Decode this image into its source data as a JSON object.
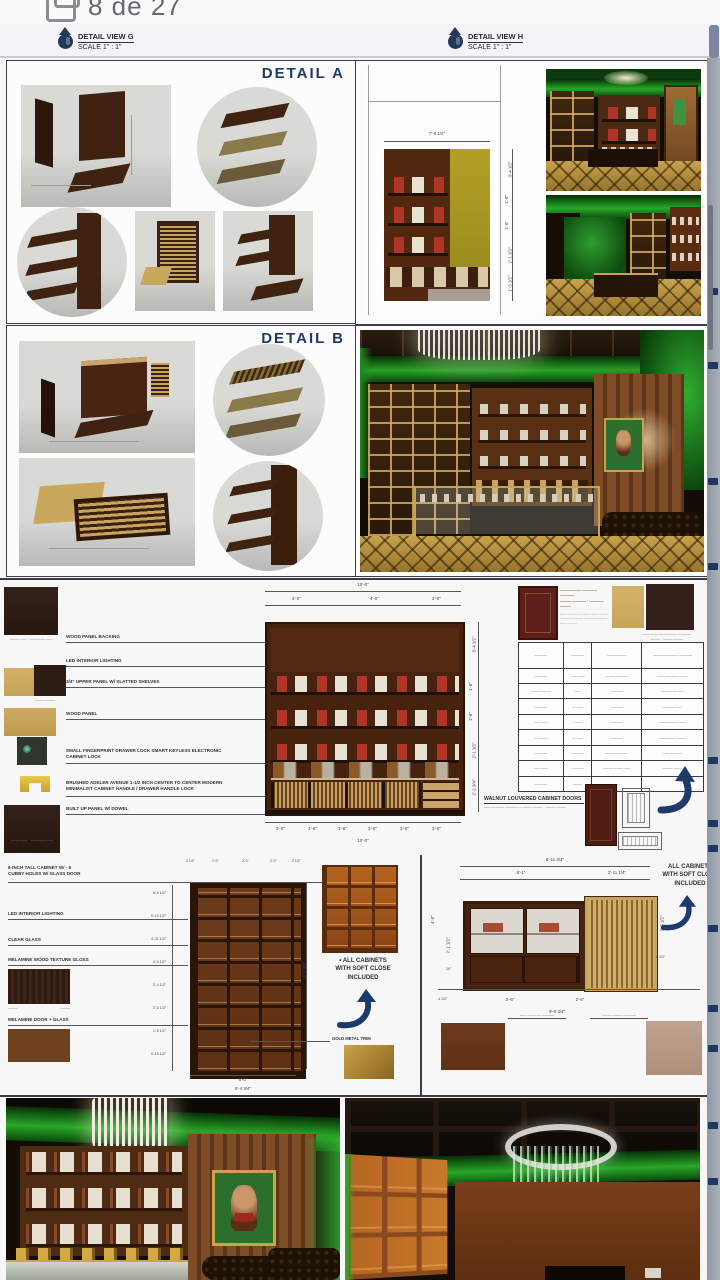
{
  "viewer": {
    "page_indicator": "8 de 27"
  },
  "header": {
    "views": [
      {
        "title": "DETAIL VIEW G",
        "scale": "SCALE 1\" : 1\""
      },
      {
        "title": "DETAIL VIEW H",
        "scale": "SCALE 1\" : 1\""
      }
    ]
  },
  "details": {
    "a": "DETAIL A",
    "b": "DETAIL B"
  },
  "colors": {
    "accent_navy": "#1f3864",
    "green_glow": "#28a828",
    "walnut": "#4a2412",
    "gold": "#b8903e"
  },
  "upper_elev": {
    "top": "7'-0 1/2\"",
    "right": [
      "3'-4 1/2\"",
      "1'-6\"",
      "1'-6\"",
      "2'-1 1/2\"",
      "1'-3 1/2\""
    ]
  },
  "middle": {
    "annotations": [
      "WOOD PANEL BACKING",
      "LED INTERIOR LIGHTING",
      "3/4\" UPPER PANEL W/ SLATTED SHELVES",
      "WOOD PANEL",
      "SMALL FINGERPRINT DRAWER LOCK SMART KEYLESS ELECTRONIC CABINET LOCK",
      "BRUSHED ADELER AVENUE 1-1/2 INCH CENTER TO CENTER MODERN MINIMALIST CABINET HANDLE / DRAWER HANDLE LOCK",
      "BUILT UP PANEL W/ DOWEL"
    ],
    "swatch_captions": [
      "——— —— · ————— ——",
      "——— ———",
      "——— —— · ————— ——"
    ],
    "elev": {
      "top_overall": "10'-0\"",
      "top_segs": [
        "4'-0\"",
        "4'-0\"",
        "2'-0\""
      ],
      "right": [
        "3'-4 1/2\"",
        "1'-6\"",
        "1'-6\"",
        "2'-1 1/2\"",
        "2'-2 3/4\""
      ],
      "bottom_segs": [
        "2'-0\"",
        "1'-6\"",
        "1'-6\"",
        "2'-0\"",
        "2'-0\"",
        "2'-0\""
      ],
      "bottom_overall": "10'-0\""
    },
    "spec": {
      "title": "—————— ———— ————",
      "title2": "——— ———— · ———— ———",
      "para": "—— ———— ——— —— ——— ———— ——— ——— ———— —— ———",
      "headers": [
        "————",
        "————",
        "——————",
        "———————— ————"
      ],
      "rows": [
        [
          "————",
          "— — ——",
          "——— ————",
          "—— ———— ———"
        ],
        [
          "——— ———",
          "——",
          "————",
          "————— ——"
        ],
        [
          "————",
          "— ——",
          "————",
          "———— ——"
        ],
        [
          "—— ——",
          "– ——",
          "————",
          "—————— ——"
        ],
        [
          "— ———",
          "— ——",
          "————",
          "————— ———"
        ],
        [
          "————",
          "—— ——",
          "——— ————",
          "—— ————"
        ],
        [
          "—— ——",
          "– ———",
          "——— ——— ——",
          "——— ———"
        ],
        [
          "————",
          "———",
          "——",
          ""
        ]
      ]
    },
    "walnut_label": "WALNUT LOUVERED CABINET DOORS",
    "walnut_sub": "—— ———— ———— — ——— ——— · ——— ———"
  },
  "tall": {
    "annotations": [
      "6-INCH TALL CABINET W/ - 6",
      "CUBBY HOLES W/ GLASS DOOR",
      "LED INTERIOR LIGHTING",
      "CLEAR GLASS",
      "MELAMINE WOOD TEXTURE GLOSS",
      "MELAMINE DOOR + GLASS"
    ],
    "top_dims": [
      "2 1/2\"",
      "2'-0\"",
      "2'-0\"",
      "2'-0\"",
      "2 1/2\""
    ],
    "left_dims": [
      "6'-9 1/2\"",
      "5'-10 1/2\"",
      "4'-11 1/2\"",
      "4'-0 1/2\"",
      "3'-4 1/2\"",
      "2'-5 1/2\"",
      "1'-9 1/2\"",
      "0'-10 1/2\""
    ],
    "right_dim": "6'-9 3/4\"",
    "bottom_dims": [
      "6'-0\"",
      "6'-4 3/4\""
    ],
    "note": [
      "•  ALL CABINETS",
      "WITH SOFT CLOSE",
      "INCLUDED"
    ],
    "gold_label": "GOLD METAL TRIM"
  },
  "low": {
    "note": [
      "ALL CABINETS",
      "WITH SOFT CLOSE",
      "INCLUDED"
    ],
    "top_overall": "8'-11 3/4\"",
    "top_segs": [
      "6'-1\"",
      "2'-11 1/4\""
    ],
    "left_dims": [
      "4'-0\"",
      "2'-1 1/2\"",
      "10\""
    ],
    "right_dims": [
      "3'-0 1/2\"",
      "6 1/2\""
    ],
    "bottom_dims": [
      "2'-6\"",
      "2'-6\"",
      "9'-0 3/4\"",
      "4 1/2\""
    ],
    "labels": [
      "—— ——— — ————",
      "——— ——— ————"
    ],
    "swatch_captions": [
      "———",
      "———"
    ]
  }
}
